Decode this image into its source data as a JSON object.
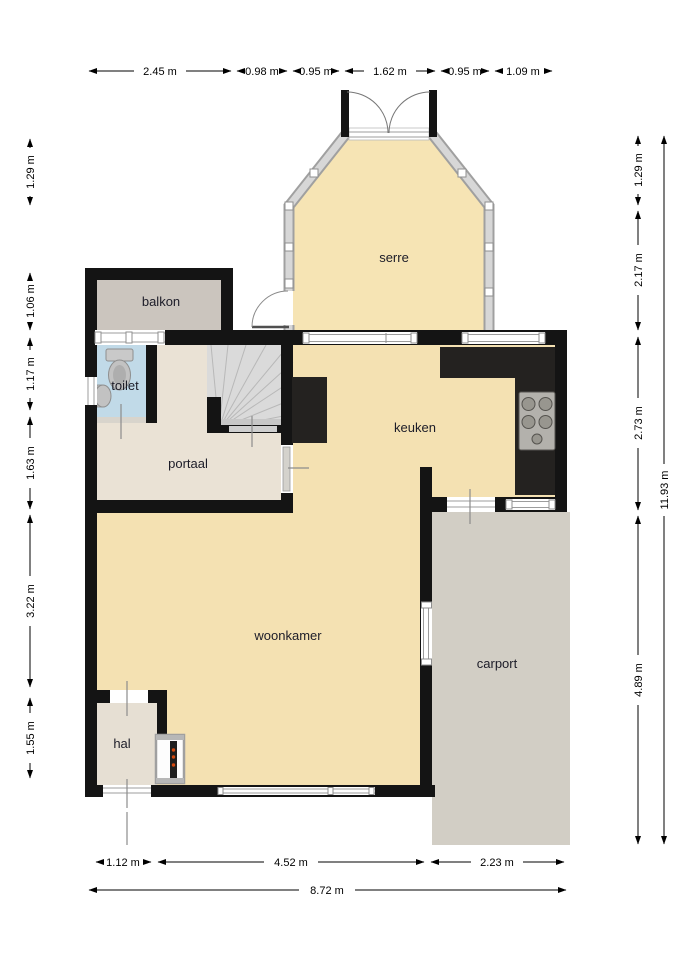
{
  "rooms": {
    "serre": "serre",
    "balkon": "balkon",
    "toilet": "toilet",
    "portaal": "portaal",
    "keuken": "keuken",
    "woonkamer": "woonkamer",
    "hal": "hal",
    "carport": "carport"
  },
  "dims": {
    "top": [
      "2.45 m",
      "0.98 m",
      "0.95 m",
      "1.62 m",
      "0.95 m",
      "1.09 m"
    ],
    "left": [
      "1.29 m",
      "1.06 m",
      "1.17 m",
      "1.63 m",
      "3.22 m",
      "1.55 m"
    ],
    "right": [
      "1.29 m",
      "2.17 m",
      "2.73 m",
      "4.89 m"
    ],
    "right_total": "11.93 m",
    "bottom": [
      "1.12 m",
      "4.52 m",
      "2.23 m"
    ],
    "bottom_total": "8.72 m"
  },
  "colors": {
    "floor_warm": "#f4e1b2",
    "serre_floor": "#f6e4b4",
    "floor_neutral": "#eae2d5",
    "hal_floor": "#e6dfd3",
    "toilet_blue": "#c1dae8",
    "balkon_gray": "#cbc5be",
    "carport_gray": "#d2cec5",
    "wall_black": "#141414",
    "counter_dark": "#242220",
    "stair_gray": "#dadada",
    "glass_gray": "#c9c9c9"
  }
}
